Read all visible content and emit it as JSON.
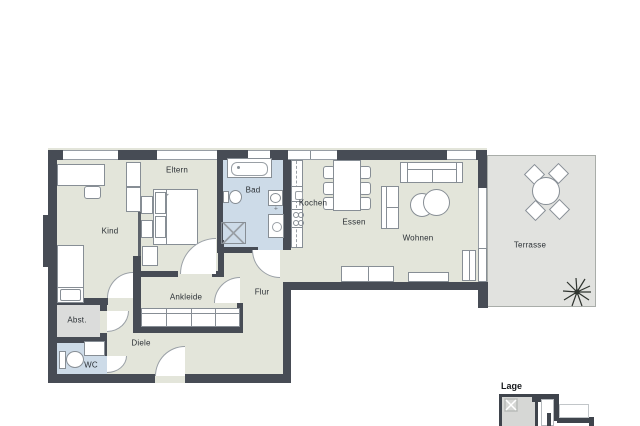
{
  "plan": {
    "type": "apartment-floor-plan",
    "rooms": [
      {
        "id": "kind",
        "label": "Kind"
      },
      {
        "id": "eltern",
        "label": "Eltern"
      },
      {
        "id": "bad",
        "label": "Bad"
      },
      {
        "id": "kochen",
        "label": "Kochen"
      },
      {
        "id": "essen",
        "label": "Essen"
      },
      {
        "id": "wohnen",
        "label": "Wohnen"
      },
      {
        "id": "terrasse",
        "label": "Terrasse"
      },
      {
        "id": "flur",
        "label": "Flur"
      },
      {
        "id": "ankleide",
        "label": "Ankleide"
      },
      {
        "id": "diele",
        "label": "Diele"
      },
      {
        "id": "abstellraum",
        "label": "Abst."
      },
      {
        "id": "wc",
        "label": "WC"
      }
    ],
    "legend": {
      "lage_label": "Lage"
    },
    "furniture_icons": [
      "desk-icon",
      "chair-icon",
      "single-bed-icon",
      "double-bed-icon",
      "nightstand-icon",
      "wardrobe-icon",
      "dresser-icon",
      "bathtub-icon",
      "toilet-icon",
      "washbasin-icon",
      "shower-icon",
      "washing-machine-icon",
      "kitchen-counter-icon",
      "sink-icon",
      "stove-icon",
      "dining-table-icon",
      "sofa-icon",
      "coffee-table-icon",
      "sideboard-icon",
      "radiator-icon",
      "terrace-table-icon",
      "terrace-chair-icon",
      "plant-icon",
      "door-swing-icon",
      "window-icon"
    ],
    "colors": {
      "wall": "#474c55",
      "floor_living": "#e3e5da",
      "floor_wet": "#cddbe8",
      "floor_storage": "#dbdcdb",
      "floor_terrace": "#e1e2df",
      "furniture_outline": "#878e95",
      "label_text": "#2b3035"
    }
  }
}
